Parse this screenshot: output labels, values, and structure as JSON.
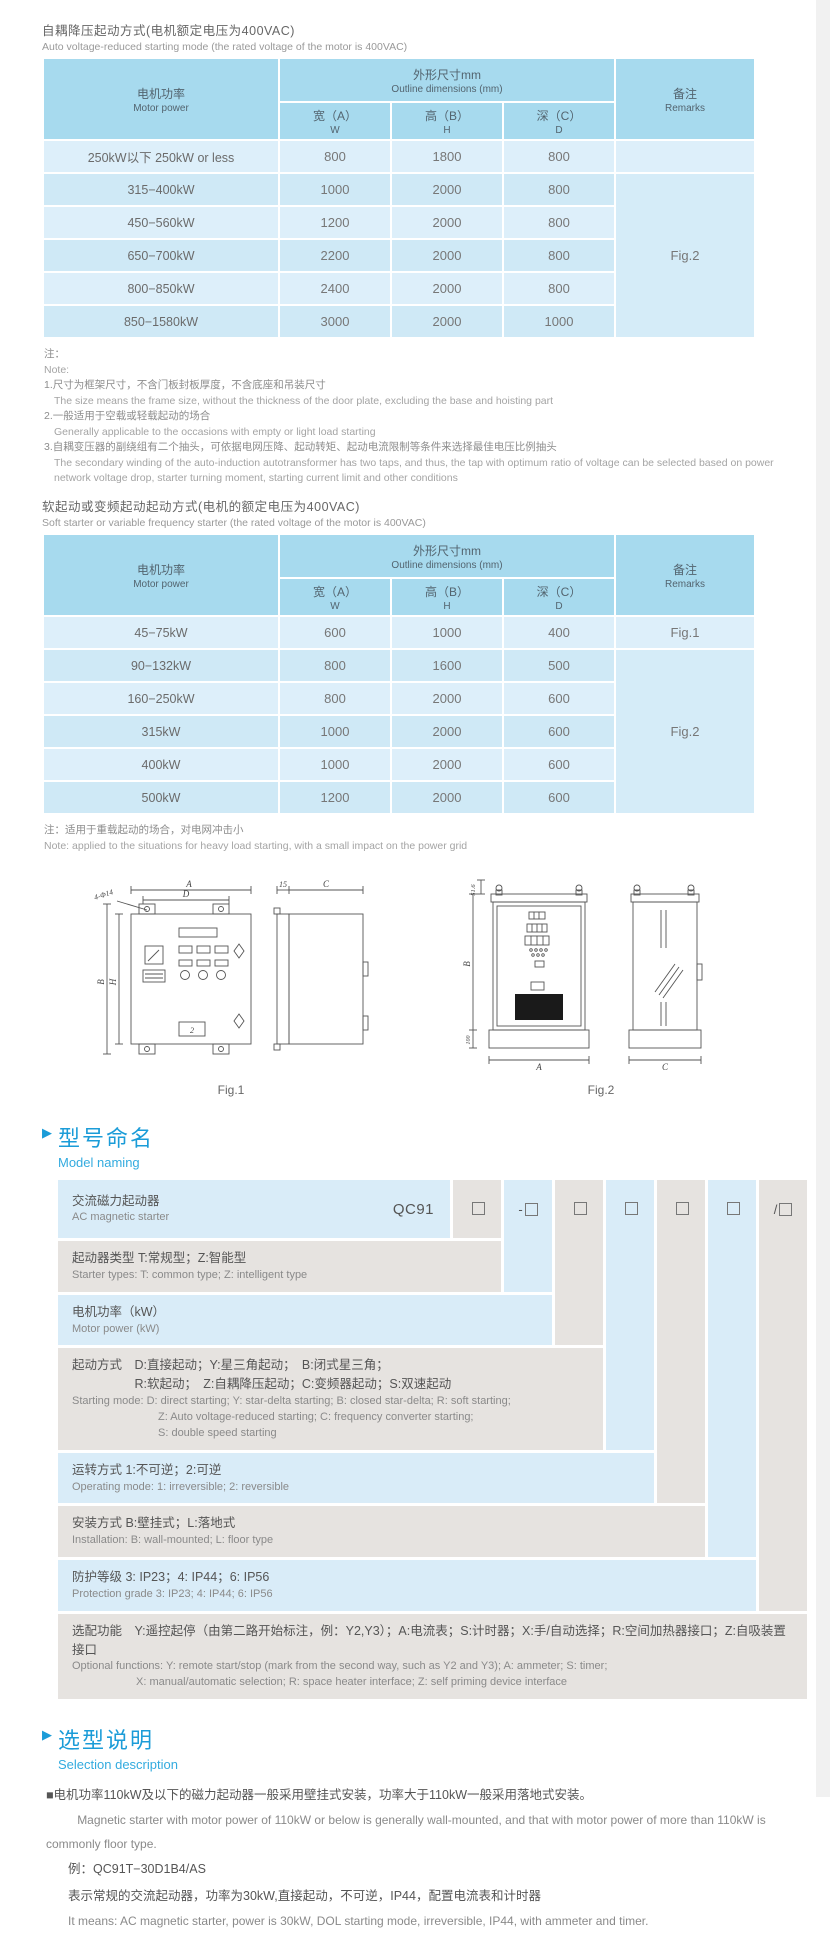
{
  "section1": {
    "title_zh": "自耦降压起动方式(电机额定电压为400VAC)",
    "title_en": "Auto voltage-reduced starting mode (the rated voltage of the motor is 400VAC)"
  },
  "table_headers": {
    "motor_power_zh": "电机功率",
    "motor_power_en": "Motor power",
    "outline_zh": "外形尺寸mm",
    "outline_en": "Outline dimensions (mm)",
    "width_zh": "宽（A）",
    "width_en": "W",
    "height_zh": "高（B）",
    "height_en": "H",
    "depth_zh": "深（C）",
    "depth_en": "D",
    "remarks_zh": "备注",
    "remarks_en": "Remarks"
  },
  "table1": {
    "rows": [
      {
        "power": "250kW以下 250kW or less",
        "w": "800",
        "h": "1800",
        "d": "800",
        "remark": ""
      },
      {
        "power": "315−400kW",
        "w": "1000",
        "h": "2000",
        "d": "800"
      },
      {
        "power": "450−560kW",
        "w": "1200",
        "h": "2000",
        "d": "800"
      },
      {
        "power": "650−700kW",
        "w": "2200",
        "h": "2000",
        "d": "800"
      },
      {
        "power": "800−850kW",
        "w": "2400",
        "h": "2000",
        "d": "800"
      },
      {
        "power": "850−1580kW",
        "w": "3000",
        "h": "2000",
        "d": "1000"
      }
    ],
    "merged_remark": "Fig.2"
  },
  "note1": {
    "zh_label": "注：",
    "en_label": "Note:",
    "item1_zh": "1.尺寸为框架尺寸，不含门板封板厚度，不含底座和吊装尺寸",
    "item1_en": "The size means the frame size, without the thickness of the door plate, excluding the base and hoisting part",
    "item2_zh": "2.一般适用于空载或轻载起动的场合",
    "item2_en": "Generally applicable to the occasions with empty or light load starting",
    "item3_zh": "3.自耦变压器的副绕组有二个抽头，可依据电网压降、起动转矩、起动电流限制等条件来选择最佳电压比例抽头",
    "item3_en": "The secondary winding of the auto-induction autotransformer has two taps, and thus, the tap with optimum ratio of voltage can be selected based on power network voltage drop, starter turning moment, starting current limit and other conditions"
  },
  "section2": {
    "title_zh": "软起动或变频起动起动方式(电机的额定电压为400VAC)",
    "title_en": "Soft starter or variable frequency starter (the rated voltage of the motor is 400VAC)"
  },
  "table2": {
    "rows": [
      {
        "power": "45−75kW",
        "w": "600",
        "h": "1000",
        "d": "400",
        "remark": "Fig.1"
      },
      {
        "power": "90−132kW",
        "w": "800",
        "h": "1600",
        "d": "500"
      },
      {
        "power": "160−250kW",
        "w": "800",
        "h": "2000",
        "d": "600"
      },
      {
        "power": "315kW",
        "w": "1000",
        "h": "2000",
        "d": "600"
      },
      {
        "power": "400kW",
        "w": "1000",
        "h": "2000",
        "d": "600"
      },
      {
        "power": "500kW",
        "w": "1200",
        "h": "2000",
        "d": "600"
      }
    ],
    "merged_remark": "Fig.2"
  },
  "note2": {
    "zh": "注：适用于重载起动的场合，对电网冲击小",
    "en": "Note: applied to the situations for heavy load starting, with a small impact on the power grid"
  },
  "figures": {
    "fig1": {
      "caption": "Fig.1",
      "dim_a": "A",
      "dim_d": "D",
      "holes": "4-Φ14",
      "dim_b": "B",
      "dim_h": "H",
      "dim_15": "15",
      "dim_c": "C",
      "panel_num": "2"
    },
    "fig2": {
      "caption": "Fig.2",
      "dim_516": "51.6",
      "dim_b": "B",
      "dim_100": "100",
      "dim_a": "A",
      "dim_c": "C"
    }
  },
  "model_naming": {
    "marker": "▶",
    "title_zh": "型号命名",
    "title_en": "Model naming",
    "base_code": "QC91",
    "box_prefixes": [
      "",
      "-",
      "",
      "",
      "",
      "",
      "/"
    ],
    "row1_zh": "交流磁力起动器",
    "row1_en": "AC magnetic starter",
    "row2_zh": "起动器类型 T:常规型；Z:智能型",
    "row2_en": "Starter types: T: common type; Z: intelligent type",
    "row3_zh": "电机功率（kW）",
    "row3_en": "Motor power (kW)",
    "row4_zh_label": "起动方式",
    "row4_zh1": "D:直接起动；Y:星三角起动；　B:闭式星三角；",
    "row4_zh2": "R:软起动；　Z:自耦降压起动；C:变频器起动；S:双速起动",
    "row4_en1": "Starting mode: D: direct starting; Y: star-delta starting; B: closed star-delta; R: soft starting;",
    "row4_en2": "Z: Auto voltage-reduced starting; C: frequency converter starting;",
    "row4_en3": "S: double speed starting",
    "row5_zh": "运转方式 1:不可逆；2:可逆",
    "row5_en": "Operating mode: 1: irreversible; 2: reversible",
    "row6_zh": "安装方式 B:壁挂式；L:落地式",
    "row6_en": "Installation: B: wall-mounted;  L: floor type",
    "row7_zh": "防护等级 3: IP23；4: IP44；6: IP56",
    "row7_en": "Protection grade  3: IP23;  4: IP44;  6: IP56",
    "row8_zh": "选配功能　Y:遥控起停（由第二路开始标注，例：Y2,Y3）；A:电流表；S:计时器；X:手/自动选择；R:空间加热器接口；Z:自吸装置接口",
    "row8_en1": "Optional functions: Y: remote start/stop (mark from the second way, such as Y2 and Y3); A: ammeter; S: timer;",
    "row8_en2": "X: manual/automatic selection; R: space heater interface; Z: self priming device interface"
  },
  "selection": {
    "marker": "▶",
    "title_zh": "选型说明",
    "title_en": "Selection description",
    "p1_zh": "■电机功率110kW及以下的磁力起动器一般采用壁挂式安装，功率大于110kW一般采用落地式安装。",
    "p1_en": "Magnetic starter with motor power of 110kW or below is generally wall-mounted, and that with motor power of more than 110kW is commonly floor type.",
    "example": "例：QC91T−30D1B4/AS",
    "p2_zh": "表示常规的交流起动器，功率为30kW,直接起动，不可逆，IP44，配置电流表和计时器",
    "p2_en": "It means: AC magnetic starter, power is 30kW, DOL starting mode, irreversible, IP44, with ammeter and timer."
  }
}
